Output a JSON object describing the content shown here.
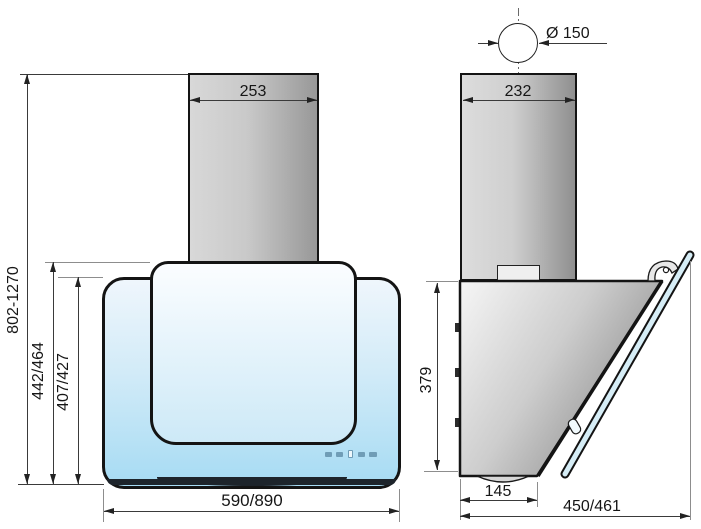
{
  "drawing": {
    "type": "technical dimension drawing",
    "subject": "wall-mounted cooker hood, front and side views"
  },
  "front_view": {
    "dim_chimney_width": "253",
    "dim_mounting_height_range": "802-1270",
    "dim_total_height": "442/464",
    "dim_glass_height": "407/427",
    "dim_width": "590/890"
  },
  "side_view": {
    "dim_duct_diameter": "Ø 150",
    "dim_chimney_width": "232",
    "dim_body_height": "379",
    "dim_body_depth": "145",
    "dim_total_depth": "450/461"
  },
  "controls": {
    "buttons": [
      "control-1",
      "control-2",
      "control-display",
      "control-3",
      "control-4"
    ]
  },
  "colors": {
    "glass_blue": "#a6dbf3",
    "steel_gray": "#c9c9c9",
    "outline": "#141414"
  }
}
